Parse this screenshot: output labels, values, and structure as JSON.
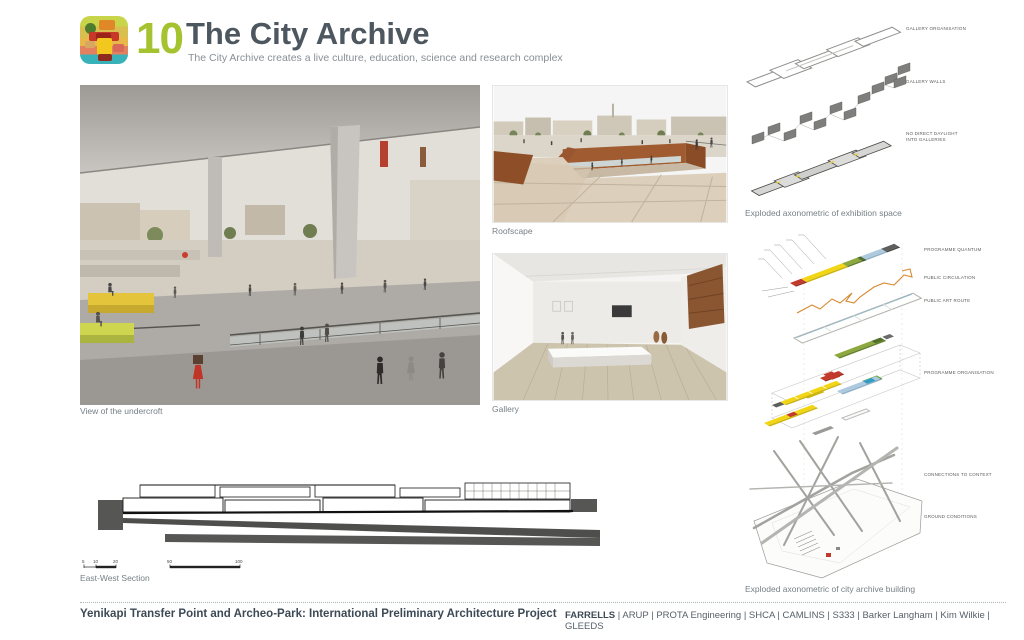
{
  "header": {
    "number": "10",
    "title": "The City Archive",
    "subtitle": "The City Archive creates a live culture, education, science and research complex"
  },
  "panels": {
    "undercroft_caption": "View of the undercroft",
    "roofscape_caption": "Roofscape",
    "gallery_caption": "Gallery"
  },
  "exhibition_diagram": {
    "caption": "Exploded axonometric of exhibition space",
    "labels": [
      "GALLERY ORGANISATION",
      "GALLERY WALLS",
      "NO DIRECT DAYLIGHT INTO GALLERIES"
    ]
  },
  "archive_diagram": {
    "caption": "Exploded axonometric of city archive building",
    "labels": [
      "PROGRAMME QUANTUM",
      "PUBLIC CIRCULATION",
      "PUBLIC ART ROUTE",
      "PROGRAMME ORGANISATION",
      "CONNECTIONS TO CONTEXT",
      "GROUND CONDITIONS"
    ]
  },
  "section": {
    "caption": "East-West Section",
    "scale_labels": [
      "5",
      "10",
      "20",
      "50",
      "100"
    ]
  },
  "footer": {
    "project_title": "Yenikapi Transfer Point and Archeo-Park: International Preliminary Architecture Project",
    "lead_firm": "FARRELLS",
    "consultants": "| ARUP | PROTA Engineering | SHCA | CAMLINS | S333 | Barker Langham | Kim Wilkie | GLEEDS"
  },
  "colors": {
    "accent_green": "#a5c32e",
    "title_gray": "#4d575f",
    "corten": "#9a5a30",
    "programme_yellow": "#f2d616",
    "programme_red": "#c23a2c",
    "programme_green": "#8ca83e",
    "programme_blue": "#aecade",
    "circulation_orange": "#d8892e"
  }
}
